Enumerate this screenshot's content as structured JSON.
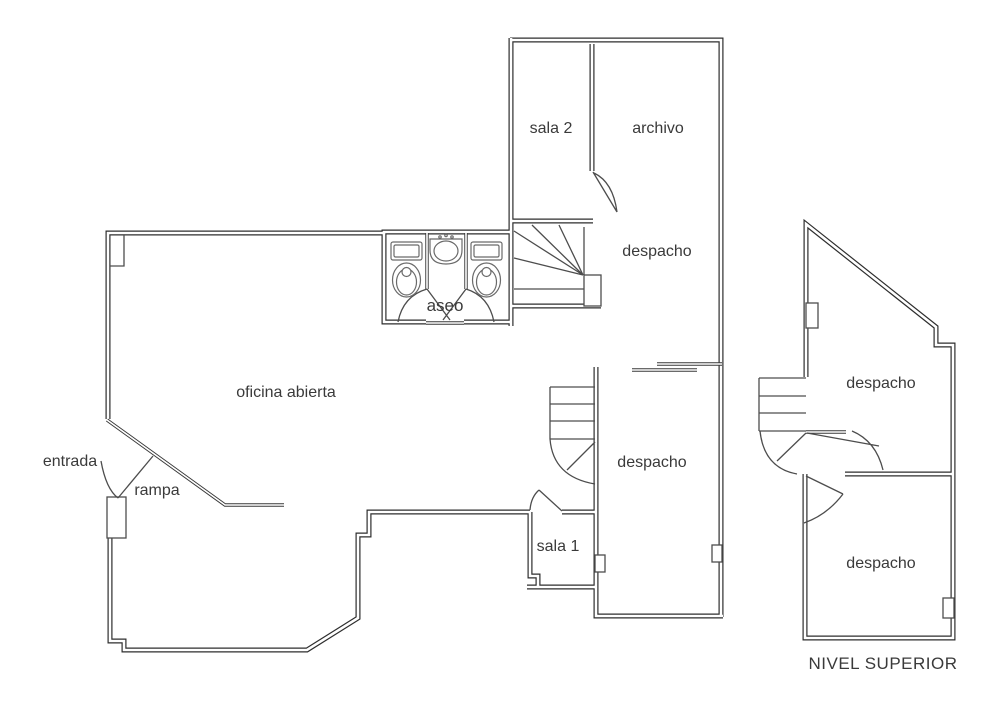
{
  "document": {
    "type": "architectural floor plan",
    "background": "#ffffff"
  },
  "plan_main": {
    "labels": {
      "sala2": "sala 2",
      "archivo": "archivo",
      "despacho_norte": "despacho",
      "aseo": "aseo",
      "oficina_abierta": "oficina abierta",
      "entrada": "entrada",
      "rampa": "rampa",
      "despacho_sur": "despacho",
      "sala1": "sala 1"
    }
  },
  "plan_superior": {
    "labels": {
      "despacho_norte": "despacho",
      "despacho_sur": "despacho"
    },
    "caption": "NIVEL SUPERIOR"
  },
  "colors": {
    "wall_line": "#2e2e2e",
    "wall_core": "#ffffff",
    "thin_line": "#4d4d4d",
    "fixture_line": "#6a6a6a",
    "text": "#3a3a3a",
    "background": "#ffffff"
  }
}
